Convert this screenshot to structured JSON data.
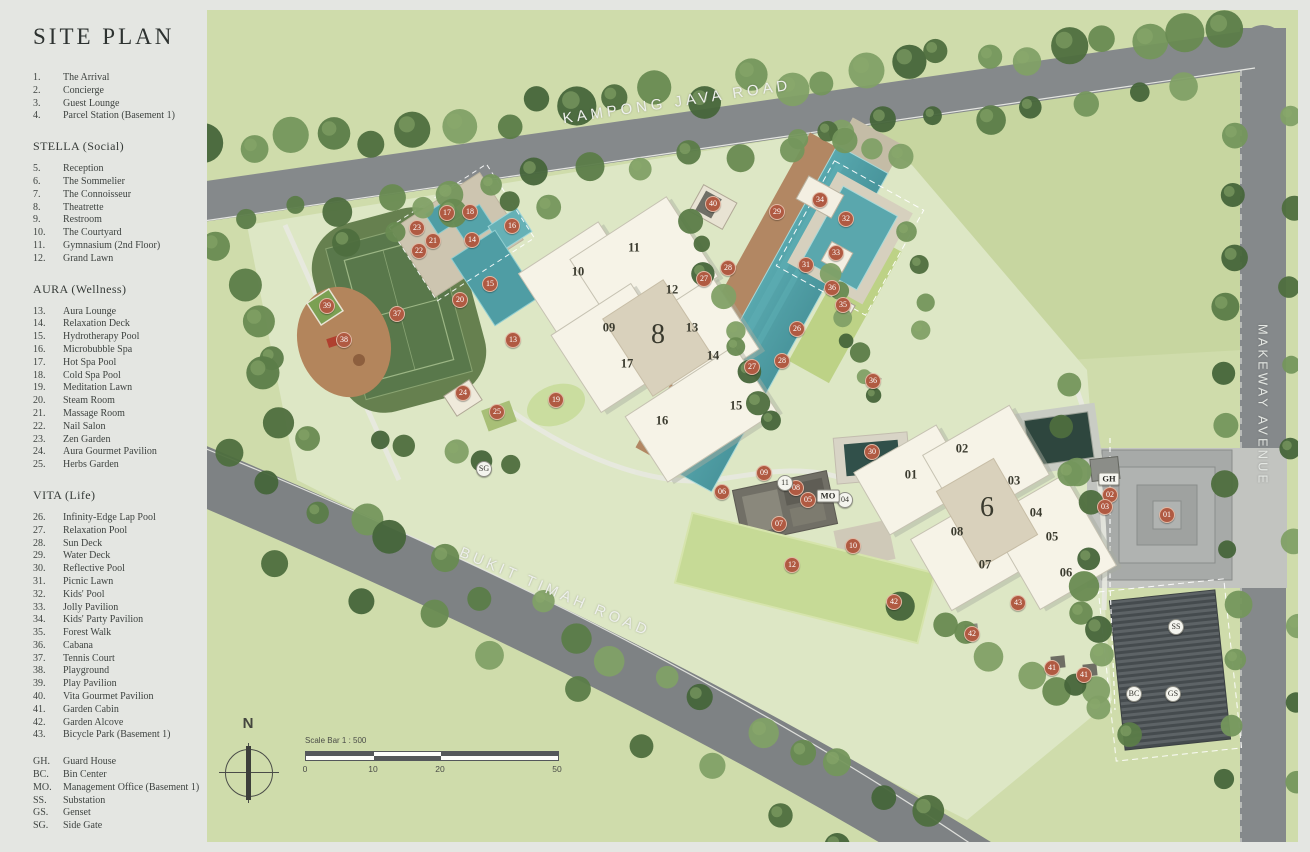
{
  "legend": {
    "title": "SITE PLAN",
    "groups": [
      {
        "heading": null,
        "items": [
          {
            "no": "1.",
            "label": "The Arrival"
          },
          {
            "no": "2.",
            "label": "Concierge"
          },
          {
            "no": "3.",
            "label": "Guest Lounge"
          },
          {
            "no": "4.",
            "label": "Parcel Station (Basement 1)"
          }
        ]
      },
      {
        "heading": "STELLA (Social)",
        "items": [
          {
            "no": "5.",
            "label": "Reception"
          },
          {
            "no": "6.",
            "label": "The Sommelier"
          },
          {
            "no": "7.",
            "label": "The Connoisseur"
          },
          {
            "no": "8.",
            "label": "Theatrette"
          },
          {
            "no": "9.",
            "label": "Restroom"
          },
          {
            "no": "10.",
            "label": "The Courtyard"
          },
          {
            "no": "11.",
            "label": "Gymnasium (2nd Floor)"
          },
          {
            "no": "12.",
            "label": "Grand Lawn"
          }
        ]
      },
      {
        "heading": "AURA (Wellness)",
        "items": [
          {
            "no": "13.",
            "label": "Aura Lounge"
          },
          {
            "no": "14.",
            "label": "Relaxation Deck"
          },
          {
            "no": "15.",
            "label": "Hydrotherapy Pool"
          },
          {
            "no": "16.",
            "label": "Microbubble Spa"
          },
          {
            "no": "17.",
            "label": "Hot Spa Pool"
          },
          {
            "no": "18.",
            "label": "Cold Spa Pool"
          },
          {
            "no": "19.",
            "label": "Meditation Lawn"
          },
          {
            "no": "20.",
            "label": "Steam Room"
          },
          {
            "no": "21.",
            "label": "Massage Room"
          },
          {
            "no": "22.",
            "label": "Nail Salon"
          },
          {
            "no": "23.",
            "label": "Zen Garden"
          },
          {
            "no": "24.",
            "label": "Aura Gourmet Pavilion"
          },
          {
            "no": "25.",
            "label": "Herbs Garden"
          }
        ]
      },
      {
        "heading": "VITA (Life)",
        "items": [
          {
            "no": "26.",
            "label": "Infinity-Edge Lap Pool"
          },
          {
            "no": "27.",
            "label": "Relaxation Pool"
          },
          {
            "no": "28.",
            "label": "Sun Deck"
          },
          {
            "no": "29.",
            "label": "Water Deck"
          },
          {
            "no": "30.",
            "label": "Reflective Pool"
          },
          {
            "no": "31.",
            "label": "Picnic Lawn"
          },
          {
            "no": "32.",
            "label": "Kids' Pool"
          },
          {
            "no": "33.",
            "label": "Jolly Pavilion"
          },
          {
            "no": "34.",
            "label": "Kids' Party Pavilion"
          },
          {
            "no": "35.",
            "label": "Forest Walk"
          },
          {
            "no": "36.",
            "label": "Cabana"
          },
          {
            "no": "37.",
            "label": "Tennis Court"
          },
          {
            "no": "38.",
            "label": "Playground"
          },
          {
            "no": "39.",
            "label": "Play Pavilion"
          },
          {
            "no": "40.",
            "label": "Vita Gourmet Pavilion"
          },
          {
            "no": "41.",
            "label": "Garden Cabin"
          },
          {
            "no": "42.",
            "label": "Garden Alcove"
          },
          {
            "no": "43.",
            "label": "Bicycle Park (Basement 1)"
          }
        ]
      },
      {
        "heading": null,
        "items": [
          {
            "no": "GH.",
            "label": "Guard House"
          },
          {
            "no": "BC.",
            "label": "Bin Center"
          },
          {
            "no": "MO.",
            "label": "Management Office (Basement 1)"
          },
          {
            "no": "SS.",
            "label": "Substation"
          },
          {
            "no": "GS.",
            "label": "Genset"
          },
          {
            "no": "SG.",
            "label": "Side Gate"
          }
        ]
      }
    ]
  },
  "map": {
    "roads": [
      {
        "name": "KAMPONG JAVA ROAD"
      },
      {
        "name": "BUKIT TIMAH ROAD"
      },
      {
        "name": "MAKEWAY AVENUE"
      }
    ],
    "compass": {
      "label": "N"
    },
    "scale_bar": {
      "label": "Scale Bar 1 : 500",
      "ticks": [
        "0",
        "10",
        "20",
        "50"
      ]
    },
    "towers": [
      {
        "number": "8",
        "x": 451,
        "y": 325,
        "units": [
          {
            "label": "10",
            "x": 371,
            "y": 262
          },
          {
            "label": "11",
            "x": 427,
            "y": 238
          },
          {
            "label": "09",
            "x": 402,
            "y": 318
          },
          {
            "label": "12",
            "x": 465,
            "y": 280
          },
          {
            "label": "13",
            "x": 485,
            "y": 318
          },
          {
            "label": "17",
            "x": 420,
            "y": 354
          },
          {
            "label": "14",
            "x": 506,
            "y": 346
          },
          {
            "label": "16",
            "x": 455,
            "y": 411
          },
          {
            "label": "15",
            "x": 529,
            "y": 396
          }
        ]
      },
      {
        "number": "6",
        "x": 780,
        "y": 498,
        "units": [
          {
            "label": "01",
            "x": 704,
            "y": 465
          },
          {
            "label": "02",
            "x": 755,
            "y": 439
          },
          {
            "label": "03",
            "x": 807,
            "y": 471
          },
          {
            "label": "04",
            "x": 829,
            "y": 503
          },
          {
            "label": "05",
            "x": 845,
            "y": 527
          },
          {
            "label": "06",
            "x": 859,
            "y": 563
          },
          {
            "label": "07",
            "x": 778,
            "y": 555
          },
          {
            "label": "08",
            "x": 750,
            "y": 522
          }
        ]
      }
    ],
    "amenity_markers": [
      {
        "label": "37",
        "x": 190,
        "y": 304
      },
      {
        "label": "38",
        "x": 137,
        "y": 330
      },
      {
        "label": "39",
        "x": 120,
        "y": 296
      },
      {
        "label": "17",
        "x": 240,
        "y": 203
      },
      {
        "label": "18",
        "x": 263,
        "y": 202
      },
      {
        "label": "16",
        "x": 305,
        "y": 216
      },
      {
        "label": "23",
        "x": 210,
        "y": 218
      },
      {
        "label": "21",
        "x": 226,
        "y": 231
      },
      {
        "label": "22",
        "x": 212,
        "y": 241
      },
      {
        "label": "14",
        "x": 265,
        "y": 230
      },
      {
        "label": "15",
        "x": 283,
        "y": 274
      },
      {
        "label": "20",
        "x": 253,
        "y": 290
      },
      {
        "label": "13",
        "x": 306,
        "y": 330
      },
      {
        "label": "19",
        "x": 349,
        "y": 390
      },
      {
        "label": "24",
        "x": 256,
        "y": 383
      },
      {
        "label": "25",
        "x": 290,
        "y": 402
      },
      {
        "label": "40",
        "x": 506,
        "y": 194
      },
      {
        "label": "29",
        "x": 570,
        "y": 202
      },
      {
        "label": "34",
        "x": 613,
        "y": 190
      },
      {
        "label": "32",
        "x": 639,
        "y": 209
      },
      {
        "label": "33",
        "x": 629,
        "y": 243
      },
      {
        "label": "31",
        "x": 599,
        "y": 255
      },
      {
        "label": "28",
        "x": 521,
        "y": 258
      },
      {
        "label": "27",
        "x": 497,
        "y": 269
      },
      {
        "label": "36",
        "x": 625,
        "y": 278
      },
      {
        "label": "35",
        "x": 636,
        "y": 295
      },
      {
        "label": "26",
        "x": 590,
        "y": 319
      },
      {
        "label": "28",
        "x": 575,
        "y": 351
      },
      {
        "label": "27",
        "x": 545,
        "y": 357
      },
      {
        "label": "36",
        "x": 666,
        "y": 371
      },
      {
        "label": "30",
        "x": 665,
        "y": 442
      },
      {
        "label": "06",
        "x": 515,
        "y": 482
      },
      {
        "label": "09",
        "x": 557,
        "y": 463
      },
      {
        "label": "08",
        "x": 589,
        "y": 478
      },
      {
        "label": "05",
        "x": 601,
        "y": 490
      },
      {
        "label": "07",
        "x": 572,
        "y": 514
      },
      {
        "label": "10",
        "x": 646,
        "y": 536
      },
      {
        "label": "12",
        "x": 585,
        "y": 555
      },
      {
        "label": "02",
        "x": 903,
        "y": 485
      },
      {
        "label": "03",
        "x": 898,
        "y": 497
      },
      {
        "label": "01",
        "x": 960,
        "y": 505
      },
      {
        "label": "42",
        "x": 687,
        "y": 592
      },
      {
        "label": "43",
        "x": 811,
        "y": 593
      },
      {
        "label": "42",
        "x": 765,
        "y": 624
      },
      {
        "label": "41",
        "x": 845,
        "y": 658
      },
      {
        "label": "41",
        "x": 877,
        "y": 665
      }
    ],
    "facility_markers": [
      {
        "label": "11",
        "x": 578,
        "y": 473,
        "shape": "circle"
      },
      {
        "label": "04",
        "x": 638,
        "y": 490,
        "shape": "circle"
      },
      {
        "label": "MO",
        "x": 621,
        "y": 486,
        "shape": "pill"
      },
      {
        "label": "GH",
        "x": 902,
        "y": 469,
        "shape": "pill"
      },
      {
        "label": "SS",
        "x": 969,
        "y": 617,
        "shape": "circle"
      },
      {
        "label": "BC",
        "x": 927,
        "y": 684,
        "shape": "circle"
      },
      {
        "label": "GS",
        "x": 966,
        "y": 684,
        "shape": "circle"
      },
      {
        "label": "SG",
        "x": 277,
        "y": 459,
        "shape": "circle"
      }
    ]
  },
  "colors": {
    "amenity_marker": "#b05a42",
    "facility_marker": "#f4f4ee",
    "pool": "#4f9da4",
    "road": "#85898b",
    "grass": "#cfdcab",
    "building": "#f6f3e7",
    "tennis": "#59784b"
  }
}
